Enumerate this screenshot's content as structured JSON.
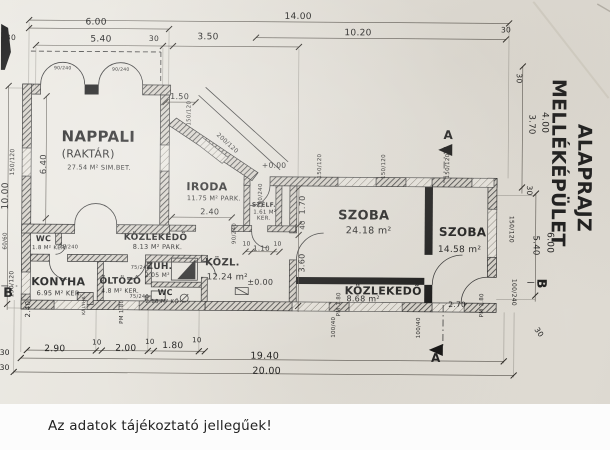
{
  "page": {
    "disclaimer": "Az adatok tájékoztató jellegűek!",
    "paper_color": "#e6e3dc",
    "ink_color": "#1f1f1f"
  },
  "plan": {
    "texts": [
      {
        "t": "14.00",
        "x": 297,
        "y": 19,
        "s": 9,
        "n": "dim-total-top-1400"
      },
      {
        "t": "10.20",
        "x": 357,
        "y": 35,
        "s": 9,
        "n": "dim-top-1020"
      },
      {
        "t": "30",
        "x": 505,
        "y": 31,
        "s": 7.5,
        "n": "dim-top-30-right"
      },
      {
        "t": "6.00",
        "x": 95,
        "y": 26,
        "s": 9,
        "n": "dim-top-600"
      },
      {
        "t": "5.40",
        "x": 100,
        "y": 43,
        "s": 9,
        "n": "dim-top-540"
      },
      {
        "t": "30",
        "x": 10,
        "y": 42,
        "s": 7.5,
        "n": "dim-top-30-left"
      },
      {
        "t": "30",
        "x": 153,
        "y": 42,
        "s": 7.5,
        "n": "dim-top-30-mid"
      },
      {
        "t": "3.50",
        "x": 207,
        "y": 40,
        "s": 9,
        "n": "dim-top-350"
      },
      {
        "t": "30",
        "x": 516,
        "y": 77,
        "s": 7.5,
        "r": 90,
        "n": "dim-right-30-top"
      },
      {
        "t": "4.00",
        "x": 542,
        "y": 121,
        "s": 9,
        "r": 90,
        "n": "dim-right-400"
      },
      {
        "t": "3.70",
        "x": 529,
        "y": 123,
        "s": 8.5,
        "r": 90,
        "n": "dim-right-370"
      },
      {
        "t": "30",
        "x": 527,
        "y": 189,
        "s": 7.5,
        "r": 90,
        "n": "dim-right-30-mid"
      },
      {
        "t": "6.00",
        "x": 548,
        "y": 241,
        "s": 9,
        "r": 90,
        "n": "dim-right-600"
      },
      {
        "t": "5.40",
        "x": 534,
        "y": 244,
        "s": 8.5,
        "r": 90,
        "n": "dim-right-540"
      },
      {
        "t": "150/120",
        "x": 510,
        "y": 228,
        "s": 6,
        "r": 90,
        "n": "window-size-right-wall"
      },
      {
        "t": "100/240",
        "x": 513,
        "y": 291,
        "s": 6,
        "r": 90,
        "n": "door-size-right-wall"
      },
      {
        "t": "B",
        "x": 538,
        "y": 282,
        "s": 13,
        "r": 90,
        "w": 1,
        "n": "section-marker-b-right"
      },
      {
        "t": "B",
        "x": 9,
        "y": 299,
        "s": 13,
        "w": 1,
        "n": "section-marker-b-left"
      },
      {
        "t": "30",
        "x": 538,
        "y": 332,
        "s": 7.5,
        "r": 55,
        "n": "dim-bottom-right-30"
      },
      {
        "t": "A",
        "x": 448,
        "y": 138,
        "s": 12,
        "w": 1,
        "n": "section-marker-a-top"
      },
      {
        "t": "A",
        "x": 437,
        "y": 361,
        "s": 12,
        "w": 1,
        "n": "section-marker-a-bottom"
      },
      {
        "t": "10.00",
        "x": 8,
        "y": 198,
        "s": 9,
        "r": -90,
        "n": "dim-left-1000"
      },
      {
        "t": "6.40",
        "x": 46,
        "y": 166,
        "s": 8.5,
        "r": -90,
        "n": "dim-left-640"
      },
      {
        "t": "150/120",
        "x": 14,
        "y": 164,
        "s": 6,
        "r": -90,
        "n": "window-size-left-upper"
      },
      {
        "t": "60/60",
        "x": 7,
        "y": 243,
        "s": 5.5,
        "r": -90,
        "n": "window-size-left-small"
      },
      {
        "t": "150/120",
        "x": 14,
        "y": 286,
        "s": 6,
        "r": -90,
        "n": "window-size-left-lower"
      },
      {
        "t": "2.40",
        "x": 31,
        "y": 311,
        "s": 7,
        "r": -90,
        "n": "dim-left-240"
      },
      {
        "t": "2.90",
        "x": 56,
        "y": 353,
        "s": 9,
        "n": "dim-bottom-290"
      },
      {
        "t": "10",
        "x": 98,
        "y": 346,
        "s": 7,
        "n": "dim-bottom-10a"
      },
      {
        "t": "2.00",
        "x": 127,
        "y": 352,
        "s": 9,
        "n": "dim-bottom-200"
      },
      {
        "t": "10",
        "x": 151,
        "y": 345,
        "s": 7,
        "n": "dim-bottom-10b"
      },
      {
        "t": "1.80",
        "x": 174,
        "y": 349,
        "s": 9,
        "n": "dim-bottom-180"
      },
      {
        "t": "10",
        "x": 198,
        "y": 343,
        "s": 7,
        "n": "dim-bottom-10c"
      },
      {
        "t": "19.40",
        "x": 266,
        "y": 359,
        "s": 9.5,
        "n": "dim-bottom-1940"
      },
      {
        "t": "20.00",
        "x": 268,
        "y": 374,
        "s": 9.5,
        "n": "dim-total-bottom-2000"
      },
      {
        "t": "30",
        "x": 6,
        "y": 357,
        "s": 7.5,
        "n": "dim-bottom-left-30a"
      },
      {
        "t": "30",
        "x": 6,
        "y": 372,
        "s": 7.5,
        "n": "dim-bottom-left-30b"
      },
      {
        "t": "PM 1.80",
        "x": 124,
        "y": 313,
        "s": 5.5,
        "r": -90,
        "n": "window-sill-pm180-a"
      },
      {
        "t": "PM 1.80",
        "x": 341,
        "y": 304,
        "s": 5.5,
        "r": -90,
        "n": "window-sill-pm180-b"
      },
      {
        "t": "PM 1.80",
        "x": 484,
        "y": 304,
        "s": 5.5,
        "r": -90,
        "n": "window-sill-pm180-c"
      },
      {
        "t": "100/40",
        "x": 336,
        "y": 327,
        "s": 5.5,
        "r": -90,
        "n": "window-size-bottom-a"
      },
      {
        "t": "100/40",
        "x": 421,
        "y": 327,
        "s": 5.5,
        "r": -90,
        "n": "window-size-bottom-b"
      },
      {
        "t": "2.70",
        "x": 458,
        "y": 306,
        "s": 7.5,
        "n": "dim-270"
      },
      {
        "t": "1.70",
        "x": 305,
        "y": 205,
        "s": 8,
        "r": -90,
        "n": "dim-170"
      },
      {
        "t": "40",
        "x": 305,
        "y": 225,
        "s": 7,
        "r": -90,
        "n": "dim-40"
      },
      {
        "t": "3.60",
        "x": 305,
        "y": 263,
        "s": 8,
        "r": -90,
        "n": "dim-360"
      },
      {
        "t": "100/240",
        "x": 262,
        "y": 196,
        "s": 5.5,
        "r": -90,
        "n": "door-size-entry"
      },
      {
        "t": "90/240",
        "x": 236,
        "y": 234,
        "s": 5.5,
        "r": -90,
        "n": "door-size-szelf"
      },
      {
        "t": "10",
        "x": 247,
        "y": 246,
        "s": 6,
        "n": "dim-10-a"
      },
      {
        "t": "1.10",
        "x": 262,
        "y": 251,
        "s": 7,
        "n": "dim-110"
      },
      {
        "t": "10",
        "x": 278,
        "y": 246,
        "s": 6,
        "n": "dim-10-b"
      },
      {
        "t": "1.50",
        "x": 179,
        "y": 100,
        "s": 8,
        "n": "dim-150"
      },
      {
        "t": "150/120",
        "x": 190,
        "y": 114,
        "s": 5.5,
        "r": -90,
        "n": "window-size-step"
      },
      {
        "t": "200/120",
        "x": 226,
        "y": 145,
        "s": 6,
        "r": 42,
        "n": "window-size-diagonal"
      },
      {
        "t": "+0.00",
        "x": 274,
        "y": 168,
        "s": 7.5,
        "n": "level-mark-entry"
      },
      {
        "t": "±0.00",
        "x": 261,
        "y": 285,
        "s": 8,
        "n": "level-mark-kozl"
      },
      {
        "t": "150/120",
        "x": 321,
        "y": 166,
        "s": 5.5,
        "r": -90,
        "n": "window-size-top-a"
      },
      {
        "t": "150/120",
        "x": 385,
        "y": 166,
        "s": 5.5,
        "r": -90,
        "n": "window-size-top-b"
      },
      {
        "t": "150/120",
        "x": 449,
        "y": 165,
        "s": 5.5,
        "r": -90,
        "n": "window-size-top-c"
      },
      {
        "t": "90/240",
        "x": 62,
        "y": 71,
        "s": 4.5,
        "n": "door-size-nappali-a"
      },
      {
        "t": "90/240",
        "x": 120,
        "y": 72,
        "s": 4.5,
        "n": "door-size-nappali-b"
      },
      {
        "t": "NAPPALI",
        "x": 98,
        "y": 143,
        "s": 15,
        "w": 1,
        "n": "room-label-nappali"
      },
      {
        "t": "(RAKTÁR)",
        "x": 88,
        "y": 159,
        "s": 11,
        "n": "room-sublabel-raktar"
      },
      {
        "t": "27.54 M² SIM.BET.",
        "x": 99,
        "y": 171,
        "s": 6.5,
        "n": "room-area-nappali"
      },
      {
        "t": "IRODA",
        "x": 207,
        "y": 191,
        "s": 11,
        "w": 1,
        "n": "room-label-iroda"
      },
      {
        "t": "11.75 M² PARK.",
        "x": 214,
        "y": 201,
        "s": 6.5,
        "n": "room-area-iroda"
      },
      {
        "t": "SZÉLF.",
        "x": 264,
        "y": 207,
        "s": 6,
        "w": 1,
        "n": "room-label-szelf"
      },
      {
        "t": "1.61 M²",
        "x": 265,
        "y": 214,
        "s": 5.5,
        "n": "room-area-szelf"
      },
      {
        "t": "KER.",
        "x": 264,
        "y": 220,
        "s": 5.5,
        "n": "room-finish-szelf"
      },
      {
        "t": "SZOBA",
        "x": 364,
        "y": 219,
        "s": 13,
        "w": 1,
        "n": "room-label-szoba-1"
      },
      {
        "t": "24.18 m²",
        "x": 369,
        "y": 233,
        "s": 9.5,
        "n": "room-area-szoba-1"
      },
      {
        "t": "SZOBA",
        "x": 463,
        "y": 235,
        "s": 12,
        "w": 1,
        "n": "room-label-szoba-2"
      },
      {
        "t": "14.58 m²",
        "x": 460,
        "y": 251,
        "s": 9,
        "n": "room-area-szoba-2"
      },
      {
        "t": "KÖZLEKEDŐ",
        "x": 384,
        "y": 294,
        "s": 11,
        "w": 1,
        "n": "room-label-kozlekedo-2"
      },
      {
        "t": "8.68 m²",
        "x": 364,
        "y": 301,
        "s": 8,
        "n": "room-area-kozlekedo-2"
      },
      {
        "t": "KÖZLEKEDŐ",
        "x": 156,
        "y": 241,
        "s": 9,
        "w": 1,
        "n": "room-label-kozlekedo-1"
      },
      {
        "t": "8.13 M² PARK.",
        "x": 158,
        "y": 250,
        "s": 6.5,
        "n": "room-area-kozlekedo-1"
      },
      {
        "t": "KÖZL.",
        "x": 223,
        "y": 266,
        "s": 10,
        "w": 1,
        "n": "room-label-kozl"
      },
      {
        "t": "12.24 m²",
        "x": 228,
        "y": 280,
        "s": 8.5,
        "n": "room-area-kozl"
      },
      {
        "t": "KONYHA",
        "x": 59,
        "y": 287,
        "s": 11,
        "w": 1,
        "n": "room-label-konyha"
      },
      {
        "t": "6.95 M² KER.",
        "x": 60,
        "y": 297,
        "s": 6.5,
        "n": "room-area-konyha"
      },
      {
        "t": "ÖLTÖZŐ",
        "x": 121,
        "y": 285,
        "s": 9,
        "w": 1,
        "n": "room-label-oltozo"
      },
      {
        "t": "4.8 M² KER.",
        "x": 121,
        "y": 294,
        "s": 6,
        "n": "room-area-oltozo"
      },
      {
        "t": "ZUH.",
        "x": 160,
        "y": 270,
        "s": 9,
        "w": 1,
        "n": "room-label-zuh"
      },
      {
        "t": "2.05 M²",
        "x": 158,
        "y": 278,
        "s": 6,
        "n": "room-area-zuh"
      },
      {
        "t": "75/240",
        "x": 141,
        "y": 270,
        "s": 5,
        "n": "door-size-zuh"
      },
      {
        "t": "WC",
        "x": 166,
        "y": 296,
        "s": 8,
        "w": 1,
        "n": "room-label-wc-2"
      },
      {
        "t": "2.18 M² KŐ",
        "x": 163,
        "y": 304,
        "s": 5.5,
        "n": "room-area-wc-2"
      },
      {
        "t": "WC",
        "x": 44,
        "y": 243,
        "s": 8,
        "w": 1,
        "n": "room-label-wc-1"
      },
      {
        "t": "1.8 M² KER.",
        "x": 50,
        "y": 251,
        "s": 5.5,
        "n": "room-area-wc-1"
      },
      {
        "t": "75/240",
        "x": 69,
        "y": 250,
        "s": 5,
        "n": "door-size-wc-1"
      },
      {
        "t": "75/240",
        "x": 140,
        "y": 299,
        "s": 5,
        "n": "door-size-wc-2"
      },
      {
        "t": "2.40",
        "x": 210,
        "y": 215,
        "s": 8,
        "n": "dim-240-iroda"
      },
      {
        "t": "KÁLYHA",
        "x": 86,
        "y": 307,
        "s": 4.5,
        "r": -90,
        "n": "fixture-label-kalyha"
      },
      {
        "t": "ALAPRAJZ",
        "x": 578,
        "y": 176,
        "s": 19,
        "r": 90,
        "w": 1,
        "ls": 2,
        "n": "title-line-1"
      },
      {
        "t": "MELLÉKÉPÜLET",
        "x": 552,
        "y": 161,
        "s": 19,
        "r": 90,
        "w": 1,
        "ls": 1,
        "n": "title-line-2"
      }
    ]
  }
}
